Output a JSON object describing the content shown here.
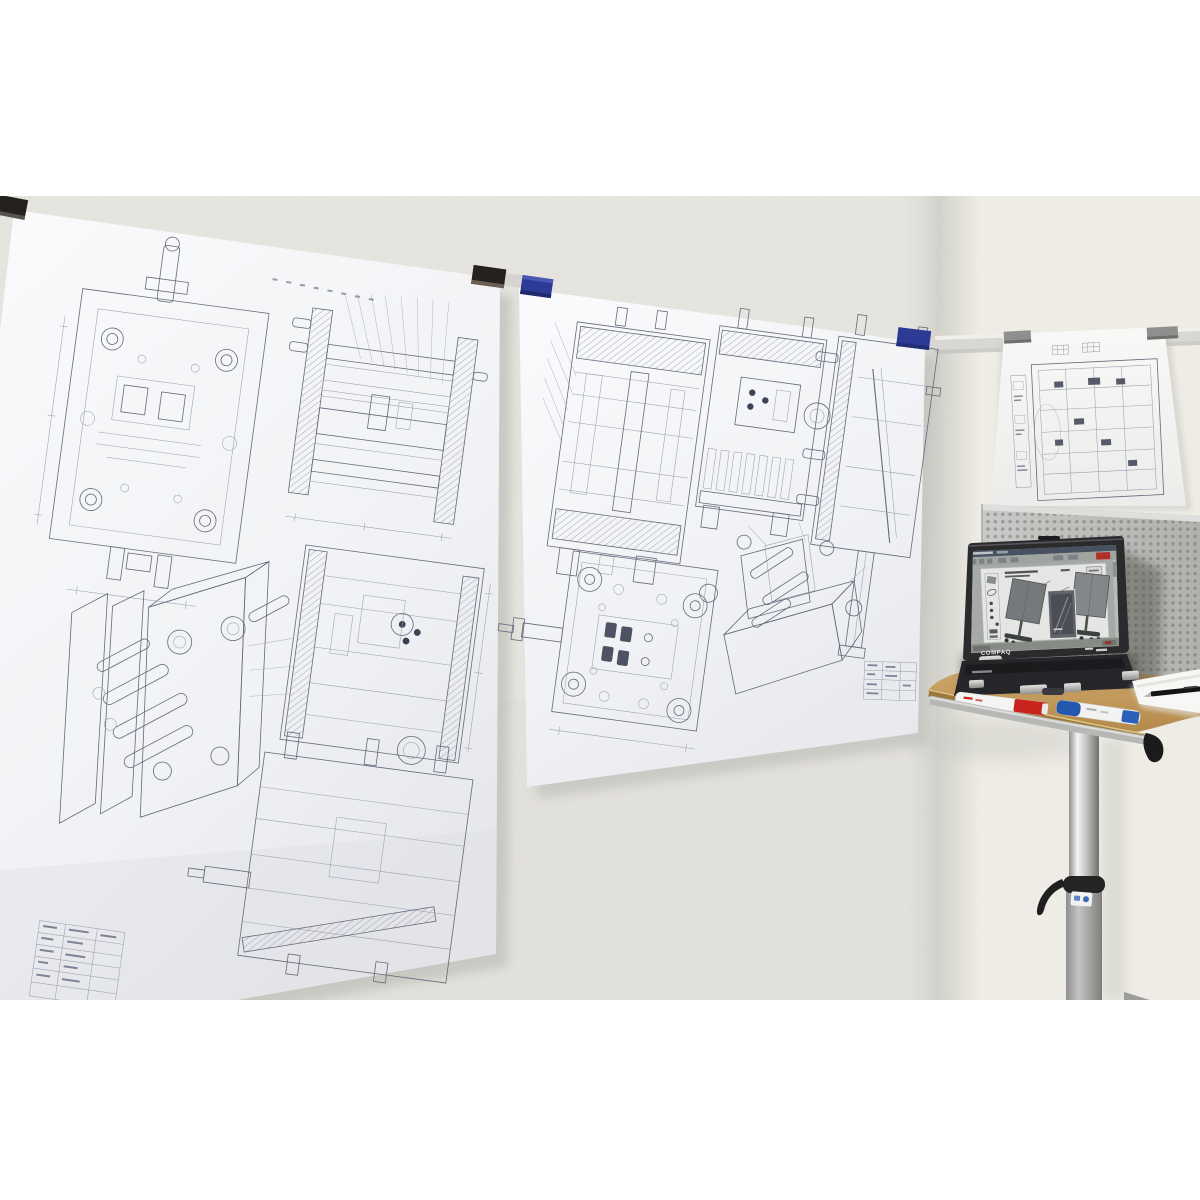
{
  "scene": {
    "type": "photograph",
    "description": "Office room corner: large engineering mold drawings clipped to wall rails, a perforated metal panel, and a Compaq laptop on a mobile pedestal stand"
  },
  "laptop": {
    "brand": "COMPAQ",
    "screen_document": "assembly instructions showing two mobile display boards",
    "badge_color": "#b23028",
    "taskbar_alert_color": "#a03028"
  },
  "colors": {
    "canvas_bg": "#ffffff",
    "wall_left": "#e9e8e2",
    "wall_right": "#f3f1ea",
    "corner_shade": "#cfcec8",
    "paper_top": "#fafafc",
    "paper_bottom": "#e8e9ed",
    "drawing_ink": "#636a7b",
    "clip_black": "#25211e",
    "clip_blue": "#2e3b96",
    "clip_gray": "#8f8f8d",
    "rail": "#d8d7d3",
    "pegboard_base": "#c9c9c7",
    "pegboard_hole": "#9a9a98",
    "wood_light": "#cfa86c",
    "wood_dark": "#b3894a",
    "wood_edge": "#9a773a",
    "tray_rail": "#b7b7b5",
    "tray_end_cap": "#1b1b1b",
    "marker_red": "#c8231c",
    "marker_blue": "#2457ae",
    "column_chrome": "#f0f0ee",
    "column_tube": "#a7a7a5",
    "clamp_black": "#1f1f1f",
    "laptop_body": "#2b2b2e",
    "pen_black": "#141416"
  },
  "wall_sheets": [
    {
      "name": "large mold drawing sheet (left wall, left)",
      "clip_color": "black",
      "view_count": "6"
    },
    {
      "name": "large mold drawing sheet (left wall, right)",
      "clip_color": "blue",
      "view_count": "6"
    },
    {
      "name": "small drawing sheet (right wall)",
      "clip_color": "gray",
      "view_count": "2"
    }
  ],
  "table": {
    "items": [
      "red marker",
      "blue marker",
      "paper stack",
      "black pen"
    ],
    "type": "round wooden top on chrome pedestal with clamp lever"
  }
}
